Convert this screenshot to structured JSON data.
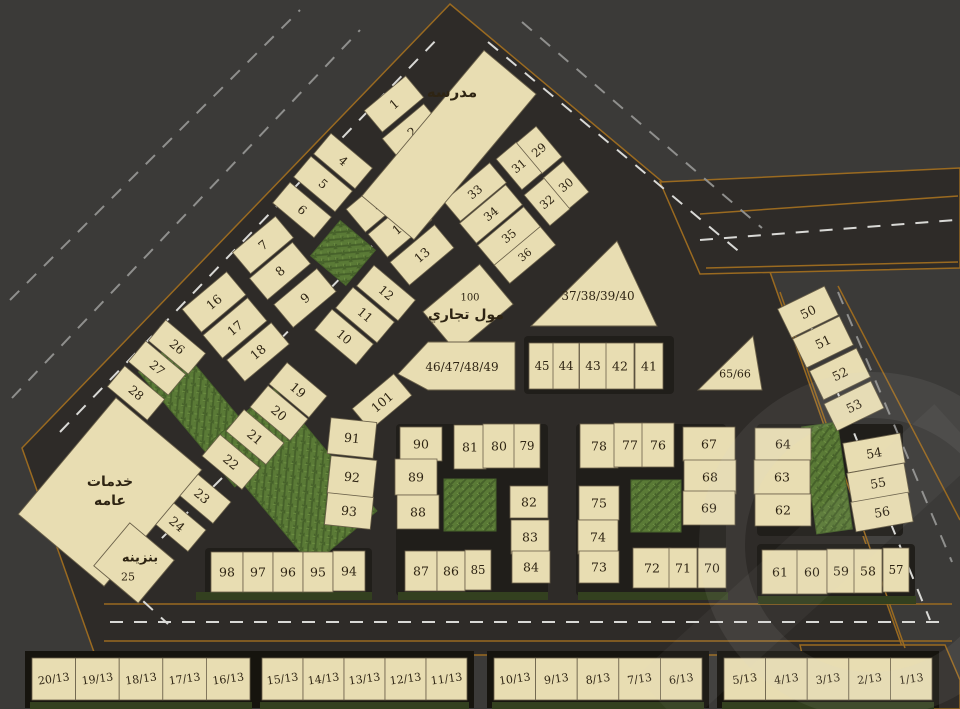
{
  "title_labels": {
    "school": "مدرسه",
    "mall_number": "100",
    "mall": "مول تجاري",
    "services_line1": "خدمات",
    "services_line2": "عامه",
    "petrol": "بنزينه",
    "petrol_number": "25"
  },
  "colors": {
    "bg": "#3b3a38",
    "road": "#2e2b28",
    "roadEdge": "#9a6a20",
    "block": "#201e1a",
    "plot": "#e8ddb2",
    "plotStroke": "#6a6049",
    "text": "#2e2413",
    "green": "#5a7a36",
    "greenDark": "#46612a",
    "greenLight": "#6d8f42",
    "dash": "#d9d9d6",
    "dashFaint": "#8f8f8d",
    "hedge": "#33401f",
    "frame": "#16140e",
    "watermark": "rgba(215,215,215,0.08)"
  },
  "map": {
    "width": 960,
    "height": 709,
    "road_polygons": [
      {
        "points": "22,448 450,4 770,272 905,655 95,655"
      },
      {
        "points": "660,182 960,168 960,268 700,274"
      },
      {
        "points": "800,645 945,645 960,680 960,709 815,709"
      }
    ],
    "blocks": [
      {
        "x": 396,
        "y": 424,
        "w": 152,
        "h": 172
      },
      {
        "x": 576,
        "y": 424,
        "w": 150,
        "h": 172
      },
      {
        "x": 757,
        "y": 424,
        "w": 146,
        "h": 112
      },
      {
        "x": 757,
        "y": 544,
        "w": 158,
        "h": 54
      },
      {
        "x": 205,
        "y": 548,
        "w": 167,
        "h": 48
      },
      {
        "x": 524,
        "y": 336,
        "w": 150,
        "h": 58
      }
    ],
    "dashes": [
      {
        "x1": 60,
        "y1": 432,
        "x2": 440,
        "y2": 36,
        "c": "dash"
      },
      {
        "x1": 12,
        "y1": 398,
        "x2": 360,
        "y2": 30,
        "c": "dashFaint"
      },
      {
        "x1": 10,
        "y1": 300,
        "x2": 300,
        "y2": 10,
        "c": "dashFaint"
      },
      {
        "x1": 488,
        "y1": 42,
        "x2": 742,
        "y2": 254,
        "c": "dash"
      },
      {
        "x1": 522,
        "y1": 22,
        "x2": 762,
        "y2": 228,
        "c": "dashFaint"
      },
      {
        "x1": 700,
        "y1": 240,
        "x2": 956,
        "y2": 220,
        "c": "dash"
      },
      {
        "x1": 800,
        "y1": 300,
        "x2": 930,
        "y2": 620,
        "c": "dash"
      },
      {
        "x1": 838,
        "y1": 292,
        "x2": 952,
        "y2": 562,
        "c": "dashFaint"
      },
      {
        "x1": 110,
        "y1": 622,
        "x2": 950,
        "y2": 622,
        "c": "dash"
      },
      {
        "x1": 55,
        "y1": 520,
        "x2": 168,
        "y2": 624,
        "c": "dash"
      },
      {
        "x1": 372,
        "y1": 246,
        "x2": 252,
        "y2": 368,
        "c": "dash"
      },
      {
        "x1": 222,
        "y1": 478,
        "x2": 128,
        "y2": 572,
        "c": "dash"
      }
    ],
    "edges": [
      {
        "x1": 104,
        "y1": 604,
        "x2": 952,
        "y2": 604
      },
      {
        "x1": 104,
        "y1": 641,
        "x2": 952,
        "y2": 641
      },
      {
        "x1": 700,
        "y1": 214,
        "x2": 958,
        "y2": 196
      },
      {
        "x1": 706,
        "y1": 268,
        "x2": 958,
        "y2": 262
      },
      {
        "x1": 780,
        "y1": 292,
        "x2": 905,
        "y2": 648
      },
      {
        "x1": 838,
        "y1": 286,
        "x2": 960,
        "y2": 520
      }
    ],
    "greens": [
      {
        "cx": 343,
        "cy": 253,
        "w": 46,
        "h": 46,
        "rot": 40
      },
      {
        "cx": 205,
        "cy": 414,
        "w": 48,
        "h": 150,
        "rot": -40
      },
      {
        "cx": 293,
        "cy": 477,
        "w": 85,
        "h": 160,
        "rot": -40
      },
      {
        "cx": 470,
        "cy": 505,
        "w": 52,
        "h": 52,
        "rot": 0
      },
      {
        "cx": 656,
        "cy": 506,
        "w": 50,
        "h": 52,
        "rot": 0
      },
      {
        "cx": 827,
        "cy": 478,
        "w": 36,
        "h": 108,
        "rot": -8
      }
    ],
    "hedges": [
      {
        "x": 196,
        "y": 592,
        "w": 176,
        "h": 8
      },
      {
        "x": 398,
        "y": 592,
        "w": 150,
        "h": 8
      },
      {
        "x": 578,
        "y": 592,
        "w": 150,
        "h": 8
      },
      {
        "x": 758,
        "y": 596,
        "w": 158,
        "h": 8
      }
    ],
    "plot_fields": [
      "label",
      "cx",
      "cy",
      "w",
      "h",
      "rot"
    ],
    "plots": [
      [
        "1",
        394,
        104,
        54,
        28,
        -40
      ],
      [
        "2",
        412,
        132,
        54,
        28,
        -40
      ],
      [
        "3",
        429,
        155,
        54,
        26,
        -40
      ],
      [
        "29",
        539,
        150,
        26,
        40,
        -40
      ],
      [
        "31",
        519,
        166,
        26,
        40,
        -40
      ],
      [
        "30",
        566,
        185,
        26,
        40,
        -40
      ],
      [
        "32",
        547,
        202,
        26,
        40,
        -40
      ],
      [
        "33",
        475,
        192,
        60,
        26,
        -40
      ],
      [
        "34",
        491,
        214,
        60,
        26,
        -40
      ],
      [
        "35",
        509,
        236,
        60,
        26,
        -40
      ],
      [
        "36",
        525,
        255,
        60,
        24,
        -40
      ],
      [
        "4",
        343,
        161,
        54,
        27,
        40
      ],
      [
        "5",
        323,
        184,
        54,
        27,
        40
      ],
      [
        "6",
        302,
        210,
        54,
        27,
        40
      ],
      [
        "7",
        263,
        245,
        56,
        28,
        -40
      ],
      [
        "8",
        280,
        271,
        56,
        28,
        -40
      ],
      [
        "9",
        305,
        298,
        56,
        30,
        -40
      ],
      [
        "15",
        378,
        202,
        58,
        30,
        -40
      ],
      [
        "14",
        400,
        227,
        58,
        30,
        -40
      ],
      [
        "13",
        422,
        255,
        58,
        30,
        -40
      ],
      [
        "12",
        386,
        293,
        54,
        27,
        40
      ],
      [
        "11",
        365,
        315,
        54,
        27,
        40
      ],
      [
        "10",
        344,
        337,
        54,
        27,
        40
      ],
      [
        "16",
        214,
        302,
        58,
        30,
        -40
      ],
      [
        "17",
        235,
        328,
        58,
        30,
        -40
      ],
      [
        "18",
        258,
        352,
        58,
        28,
        -40
      ],
      [
        "26",
        177,
        347,
        52,
        27,
        40
      ],
      [
        "27",
        157,
        368,
        52,
        27,
        40
      ],
      [
        "28",
        136,
        393,
        52,
        27,
        40
      ],
      [
        "19",
        298,
        390,
        52,
        28,
        40
      ],
      [
        "20",
        279,
        413,
        52,
        28,
        40
      ],
      [
        "21",
        255,
        437,
        52,
        28,
        40
      ],
      [
        "22",
        231,
        462,
        52,
        28,
        40
      ],
      [
        "23",
        202,
        496,
        52,
        28,
        40
      ],
      [
        "24",
        177,
        524,
        52,
        28,
        40
      ],
      [
        "101",
        382,
        402,
        54,
        28,
        -40
      ],
      [
        "91",
        352,
        438,
        46,
        36,
        6
      ],
      [
        "92",
        352,
        477,
        46,
        38,
        6
      ],
      [
        "93",
        349,
        511,
        46,
        32,
        6
      ],
      [
        "45",
        542,
        366,
        26,
        46,
        0
      ],
      [
        "44",
        566,
        366,
        26,
        46,
        0
      ],
      [
        "43",
        593,
        366,
        27,
        46,
        0
      ],
      [
        "42",
        620,
        366,
        28,
        46,
        0
      ],
      [
        "41",
        649,
        366,
        28,
        46,
        0
      ],
      [
        "50",
        808,
        312,
        52,
        32,
        -26
      ],
      [
        "51",
        823,
        342,
        52,
        32,
        -26
      ],
      [
        "52",
        840,
        374,
        52,
        32,
        -26
      ],
      [
        "53",
        854,
        406,
        52,
        30,
        -26
      ],
      [
        "54",
        874,
        453,
        58,
        30,
        -10
      ],
      [
        "55",
        878,
        483,
        58,
        30,
        -10
      ],
      [
        "56",
        882,
        512,
        58,
        30,
        -10
      ],
      [
        "64",
        783,
        444,
        56,
        32,
        0
      ],
      [
        "63",
        782,
        477,
        56,
        34,
        0
      ],
      [
        "62",
        783,
        510,
        56,
        32,
        0
      ],
      [
        "61",
        780,
        572,
        36,
        44,
        0
      ],
      [
        "60",
        812,
        572,
        30,
        44,
        0
      ],
      [
        "59",
        841,
        571,
        28,
        44,
        0
      ],
      [
        "58",
        868,
        571,
        28,
        44,
        0
      ],
      [
        "57",
        896,
        570,
        26,
        44,
        0
      ],
      [
        "67",
        709,
        444,
        52,
        34,
        0
      ],
      [
        "68",
        710,
        477,
        52,
        34,
        0
      ],
      [
        "69",
        709,
        508,
        52,
        34,
        0
      ],
      [
        "78",
        599,
        446,
        38,
        44,
        0
      ],
      [
        "77",
        630,
        445,
        32,
        44,
        0
      ],
      [
        "76",
        658,
        445,
        32,
        44,
        0
      ],
      [
        "75",
        599,
        503,
        40,
        34,
        0
      ],
      [
        "74",
        598,
        537,
        40,
        34,
        0
      ],
      [
        "73",
        599,
        567,
        40,
        32,
        0
      ],
      [
        "72",
        652,
        568,
        38,
        40,
        0
      ],
      [
        "71",
        683,
        568,
        28,
        40,
        0
      ],
      [
        "70",
        712,
        568,
        28,
        40,
        0
      ],
      [
        "90",
        421,
        444,
        42,
        34,
        0
      ],
      [
        "89",
        416,
        477,
        42,
        36,
        0
      ],
      [
        "88",
        418,
        512,
        42,
        34,
        0
      ],
      [
        "81",
        470,
        447,
        32,
        44,
        0
      ],
      [
        "80",
        499,
        446,
        32,
        44,
        0
      ],
      [
        "79",
        527,
        446,
        26,
        44,
        0
      ],
      [
        "82",
        529,
        502,
        38,
        32,
        0
      ],
      [
        "83",
        530,
        537,
        38,
        34,
        0
      ],
      [
        "84",
        531,
        567,
        38,
        32,
        0
      ],
      [
        "87",
        421,
        571,
        32,
        40,
        0
      ],
      [
        "86",
        451,
        571,
        28,
        40,
        0
      ],
      [
        "85",
        478,
        570,
        26,
        40,
        0
      ],
      [
        "98",
        227,
        572,
        32,
        40,
        0
      ],
      [
        "97",
        258,
        572,
        30,
        40,
        0
      ],
      [
        "96",
        288,
        572,
        30,
        40,
        0
      ],
      [
        "95",
        318,
        572,
        30,
        40,
        0
      ],
      [
        "94",
        349,
        571,
        32,
        40,
        0
      ]
    ],
    "special_plots": [
      {
        "name": "school",
        "shape": "rect",
        "cx": 449,
        "cy": 145,
        "w": 68,
        "h": 190,
        "rot": 40,
        "labels": [
          {
            "key": "school",
            "x": 452,
            "y": 92,
            "fs": 15,
            "bold": true,
            "ar": true
          }
        ]
      },
      {
        "name": "services",
        "shape": "rect",
        "cx": 110,
        "cy": 492,
        "w": 112,
        "h": 152,
        "rot": 40,
        "labels": [
          {
            "key": "services_line1",
            "x": 110,
            "y": 482,
            "fs": 14,
            "bold": true,
            "ar": true
          },
          {
            "key": "services_line2",
            "x": 110,
            "y": 501,
            "fs": 14,
            "bold": true,
            "ar": true
          }
        ]
      },
      {
        "name": "petrol-station",
        "shape": "rect",
        "cx": 134,
        "cy": 563,
        "w": 58,
        "h": 56,
        "rot": 40,
        "labels": [
          {
            "key": "petrol",
            "x": 140,
            "y": 558,
            "fs": 13,
            "bold": true,
            "ar": true
          },
          {
            "key": "petrol_number",
            "x": 128,
            "y": 577,
            "fs": 11,
            "bold": false,
            "ar": false
          }
        ]
      },
      {
        "name": "mall",
        "shape": "rect",
        "cx": 468,
        "cy": 308,
        "w": 74,
        "h": 52,
        "rot": -40,
        "labels": [
          {
            "key": "mall_number",
            "x": 470,
            "y": 298,
            "fs": 10,
            "bold": false,
            "ar": false
          },
          {
            "key": "mall",
            "x": 466,
            "y": 315,
            "fs": 14,
            "bold": true,
            "ar": true
          }
        ]
      },
      {
        "name": "plot-37-38-39-40",
        "shape": "poly",
        "points": "617,241 531,326 657,326",
        "labels": [
          {
            "text": "37/38/39/40",
            "x": 598,
            "y": 296,
            "fs": 12,
            "bold": false,
            "ar": false
          }
        ]
      },
      {
        "name": "plot-46-47-48-49",
        "shape": "poly",
        "points": "398,374 428,342 515,342 515,390 428,390",
        "labels": [
          {
            "text": "46/47/48/49",
            "x": 462,
            "y": 367,
            "fs": 12,
            "bold": false,
            "ar": false
          }
        ]
      },
      {
        "name": "plot-65-66",
        "shape": "poly",
        "points": "753,336 698,390 762,390",
        "labels": [
          {
            "text": "65/66",
            "x": 735,
            "y": 374,
            "fs": 11,
            "bold": false,
            "ar": false
          }
        ]
      }
    ],
    "bottom_strips": [
      {
        "x": 32,
        "y": 658,
        "w": 218,
        "h": 42,
        "cells": [
          "20/13",
          "19/13",
          "18/13",
          "17/13",
          "16/13"
        ]
      },
      {
        "x": 262,
        "y": 658,
        "w": 205,
        "h": 42,
        "cells": [
          "15/13",
          "14/13",
          "13/13",
          "12/13",
          "11/13"
        ]
      },
      {
        "x": 494,
        "y": 658,
        "w": 208,
        "h": 42,
        "cells": [
          "10/13",
          "9/13",
          "8/13",
          "7/13",
          "6/13"
        ]
      },
      {
        "x": 724,
        "y": 658,
        "w": 208,
        "h": 42,
        "cells": [
          "5/13",
          "4/13",
          "3/13",
          "2/13",
          "1/13"
        ]
      }
    ]
  }
}
